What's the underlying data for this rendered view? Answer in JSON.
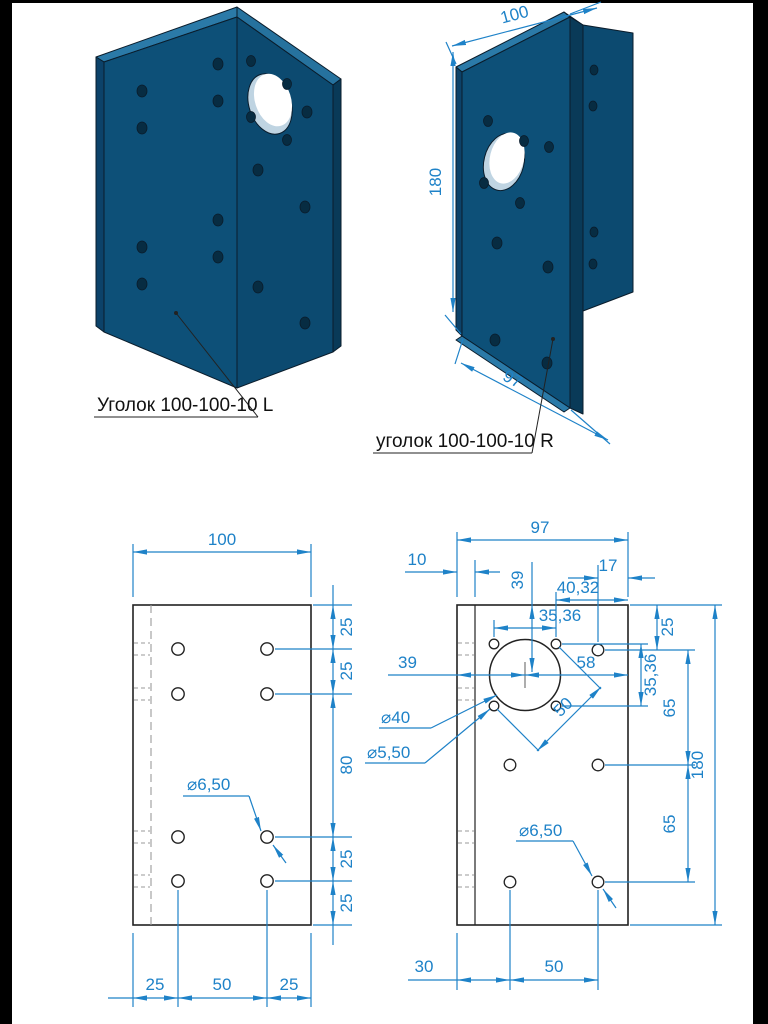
{
  "colors": {
    "backdrop": "#000000",
    "paper": "#ffffff",
    "dimension_blue": "#1e82c8",
    "outline_black": "#222222",
    "hidden_gray": "#9a9a9a",
    "part_face": "#0d5078",
    "part_face_dark": "#0c4269",
    "part_side_dark": "#093a58",
    "part_top_light": "#2b7aa8",
    "hole_fill": "#072c42"
  },
  "iso_left": {
    "label": "Уголок 100-100-10 L"
  },
  "iso_right": {
    "label": "уголок 100-100-10 R",
    "dim_width": "100",
    "dim_height": "180",
    "dim_depth": "97"
  },
  "front_view": {
    "dim_width": "100",
    "right_dims": [
      "25",
      "25",
      "80",
      "25",
      "25"
    ],
    "bottom_dims": [
      "25",
      "50",
      "25"
    ],
    "hole_callout": "⌀6,50"
  },
  "side_view": {
    "dim_width": "97",
    "dim_thickness": "10",
    "dim_center_top": "39",
    "dim_17": "17",
    "dim_4032": "40,32",
    "dim_3536_top": "35,36",
    "dim_25": "25",
    "dim_center_left": "39",
    "dim_58": "58",
    "dim_3536_right": "35,36",
    "dim_65_upper": "65",
    "dim_65_lower": "65",
    "dim_height": "180",
    "callout_big": "⌀40",
    "callout_pattern": "⌀5,50",
    "dim_50_diag": "50",
    "callout_hole": "⌀6,50",
    "dim_30": "30",
    "dim_50_bottom": "50"
  }
}
